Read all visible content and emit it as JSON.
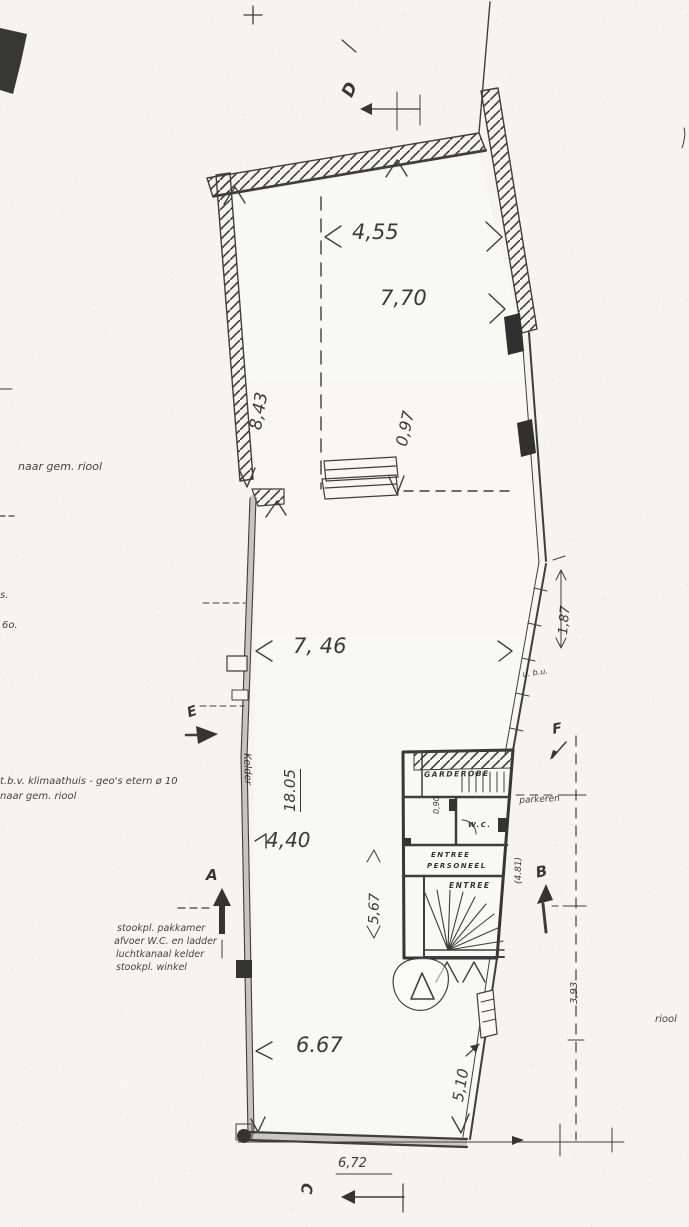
{
  "colors": {
    "ink": "#1d1d1d",
    "paper": "#f5f4f0"
  },
  "dims": {
    "d455": "4,55",
    "d770": "7,70",
    "d843": "8,43",
    "d097": "0,97",
    "d746": "7, 46",
    "d187": "1,87",
    "d1805": "18.05",
    "d440": "4,40",
    "d567": "5,67",
    "d481": "(4.81)",
    "d090": "0,90",
    "d667": "6.67",
    "d510": "5,10",
    "d393": "3,93",
    "d672": "6,72"
  },
  "markers": {
    "a": "A",
    "b": "B",
    "c": "C",
    "d": "D",
    "e": "E",
    "f": "F"
  },
  "rooms": {
    "garderobe": "GARDEROBE",
    "wc": "W.C.",
    "entree_pers_1": "ENTREE",
    "entree_pers_2": "PERSONEEL",
    "entree": "ENTREE"
  },
  "notes": {
    "riool_upper": "naar gem. riool",
    "frag_s": "s.",
    "frag_6o": "6o.",
    "klimaat_1": "t.b.v. klimaathuis - geo's etern ø 10",
    "klimaat_2": "naar gem. riool",
    "stook_lines": [
      "stookpl. pakkamer",
      "afvoer W.C. en ladder",
      "luchtkanaal kelder",
      "stookpl. winkel"
    ],
    "parkeren": "parkeren",
    "kelder": "Kelder",
    "ubu": "u. b.u.",
    "riool_right": "riool"
  }
}
